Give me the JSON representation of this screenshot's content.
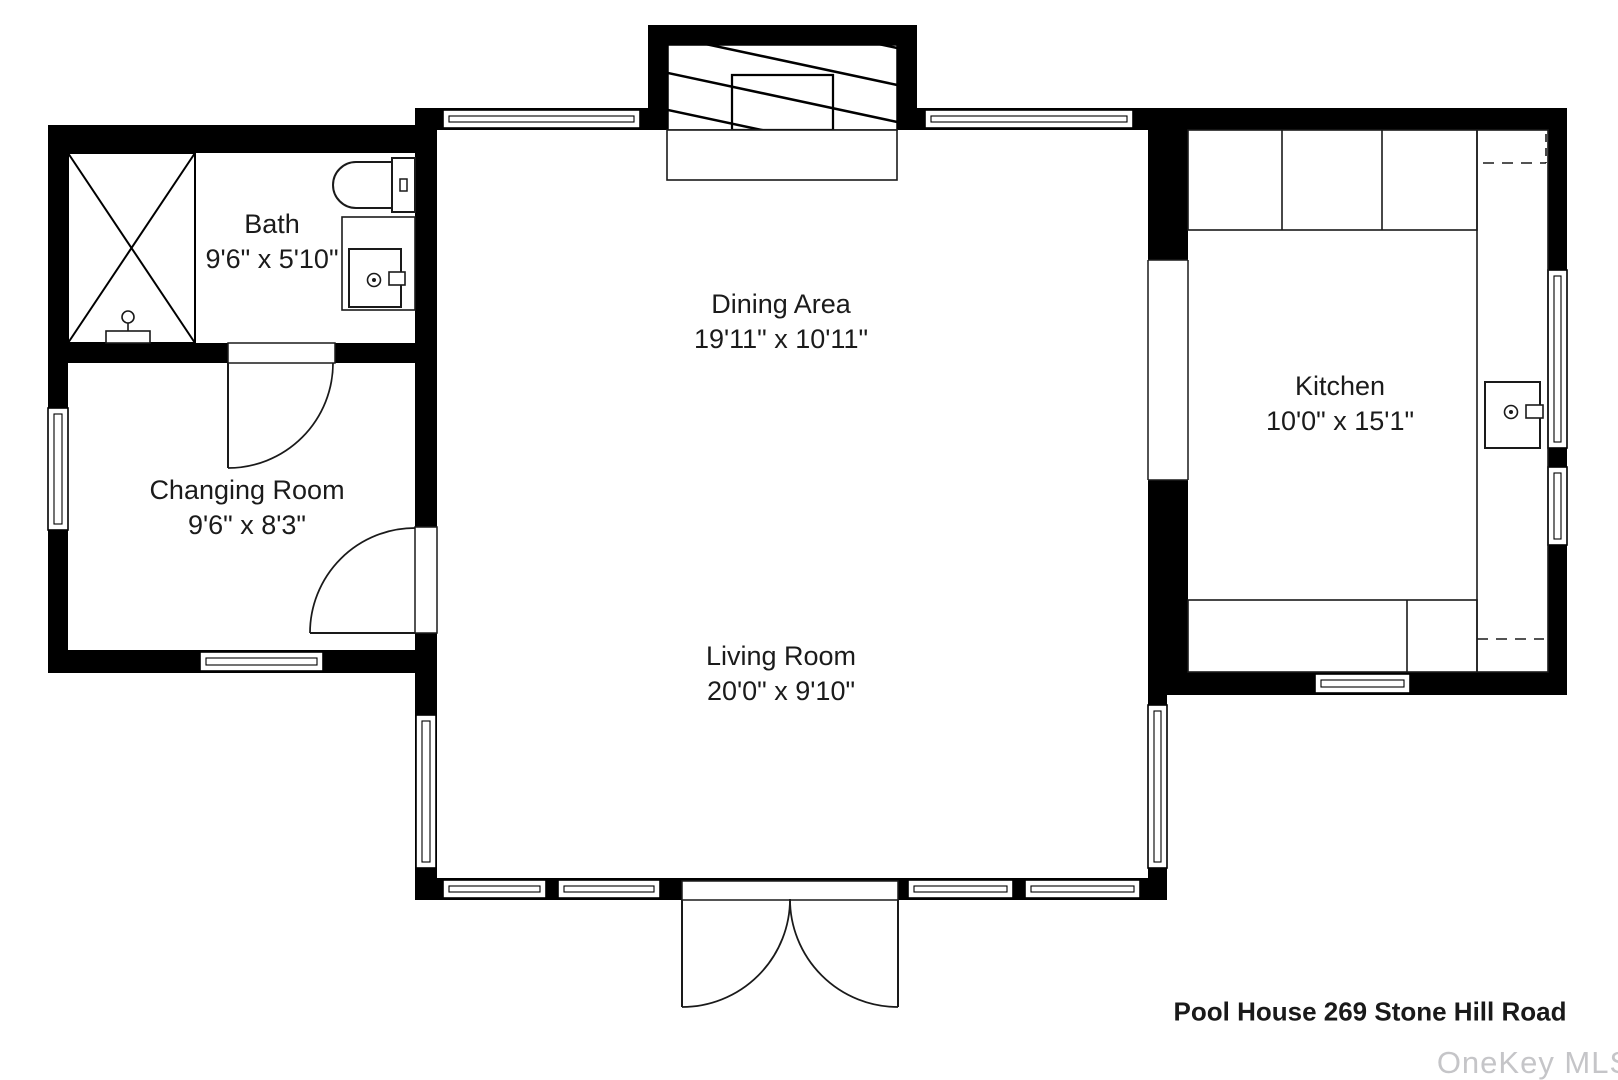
{
  "title": "Pool House 269 Stone Hill Road",
  "watermark": "OneKey MLS",
  "rooms": [
    {
      "id": "bath",
      "name": "Bath",
      "dimensions": "9'6\" x 5'10\""
    },
    {
      "id": "changing-room",
      "name": "Changing Room",
      "dimensions": "9'6\" x 8'3\""
    },
    {
      "id": "dining-area",
      "name": "Dining Area",
      "dimensions": "19'11\" x 10'11\""
    },
    {
      "id": "living-room",
      "name": "Living Room",
      "dimensions": "20'0\" x 9'10\""
    },
    {
      "id": "kitchen",
      "name": "Kitchen",
      "dimensions": "10'0\" x 15'1\""
    }
  ],
  "fixtures": [
    "shower",
    "shower-valve",
    "toilet",
    "vanity-sink",
    "fireplace",
    "hearth",
    "kitchen-upper-counter",
    "kitchen-side-counter",
    "kitchen-lower-counter",
    "kitchen-sink",
    "double-entry-door",
    "bath-door",
    "changing-room-door"
  ],
  "colors": {
    "wall": "#000000",
    "line": "#1a1a1a",
    "text": "#1b1b1b",
    "watermark": "#c5c5c8",
    "background": "#ffffff"
  }
}
